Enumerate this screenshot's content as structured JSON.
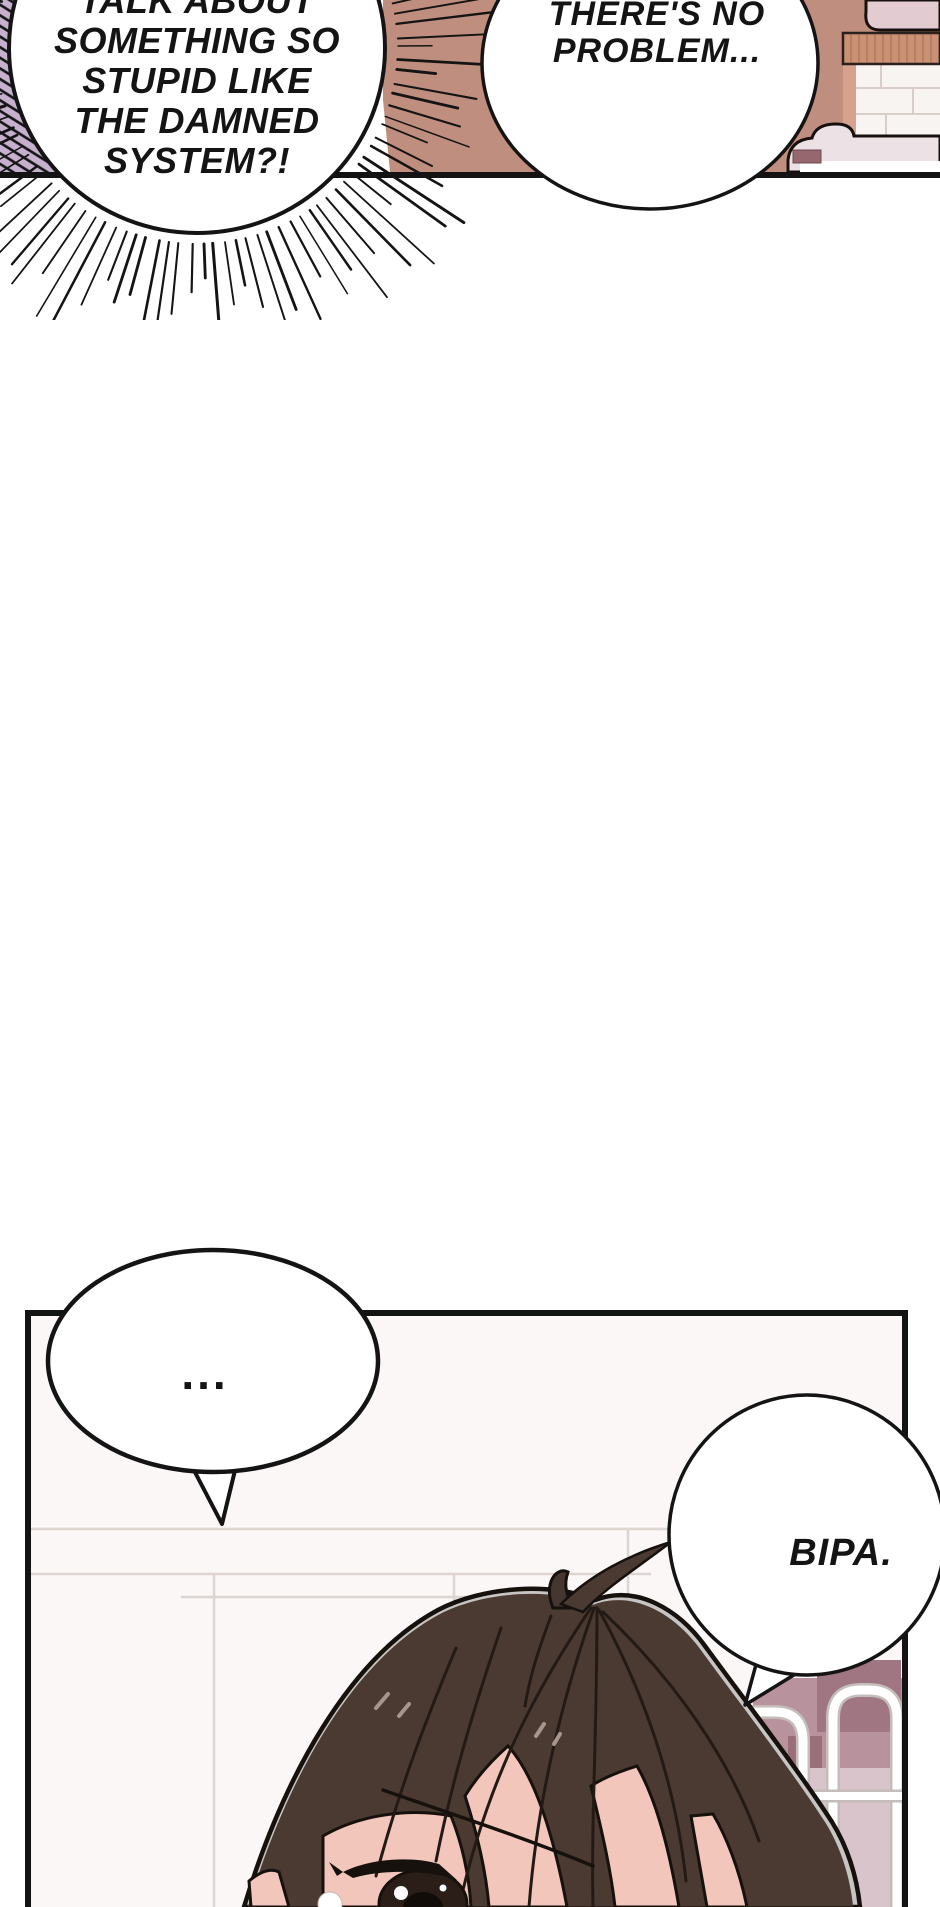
{
  "comic": {
    "panel1": {
      "shout_bubble": {
        "lines": [
          "TALK ABOUT",
          "SOMETHING SO",
          "STUPID LIKE",
          "THE DAMNED",
          "SYSTEM?!"
        ]
      },
      "reply_bubble": {
        "lines": [
          "THERE'S NO",
          "PROBLEM..."
        ]
      }
    },
    "panel2": {
      "silence_bubble": {
        "text": "..."
      },
      "name_bubble": {
        "text": "BIPA."
      }
    },
    "colors": {
      "ink": "#141414",
      "wall_brown": "#c08e7e",
      "hatch_lavender": "#c6b0ce",
      "wood_shelf": "#cb9175",
      "cushion_pink": "#e2ccd2",
      "sofa_pink": "#ece2e6",
      "accent_dark_mauve": "#97676f",
      "panel2_wall": "#fbf7f6",
      "bed_mauve": "#b8929c",
      "bed_mauve_dark": "#a07682",
      "bedding_light": "#d9c4cb",
      "hair": "#4a3a32",
      "hair_outline": "#17110d",
      "hair_rim": "#c7c5c4",
      "skin": "#f2c6bb"
    }
  }
}
